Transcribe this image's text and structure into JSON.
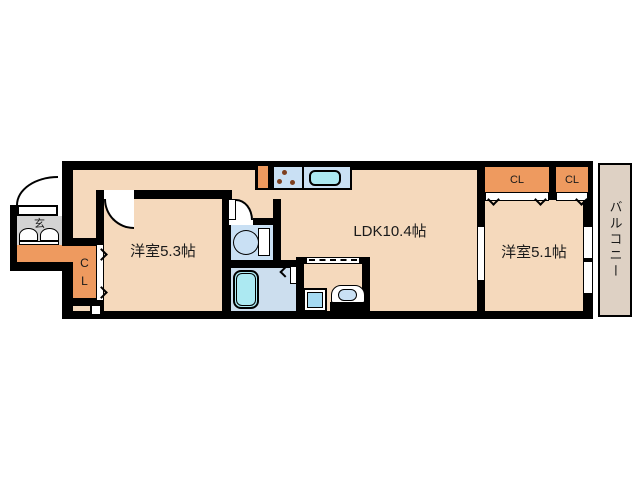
{
  "rooms": {
    "bedroom_left": {
      "label": "洋室5.3帖"
    },
    "ldk": {
      "label": "LDK10.4帖"
    },
    "bedroom_right": {
      "label": "洋室5.1帖"
    },
    "balcony": {
      "label": "バルコニー"
    },
    "entrance": {
      "label": "玄"
    },
    "hall_closet": {
      "label_top": "C",
      "label_bottom": "L"
    },
    "closet_a": {
      "label": "CL"
    },
    "closet_b": {
      "label": "CL"
    }
  },
  "colors": {
    "wall": "#000000",
    "floor": "#f5d9bc",
    "accent": "#ee9a5f",
    "gray": "#d3d3d3",
    "water": "#c9e0f4",
    "tub": "#ace9f2",
    "bathfloor": "#ccdeee",
    "balconyfloor": "#ded1c4",
    "washer": "#a5daf2"
  }
}
